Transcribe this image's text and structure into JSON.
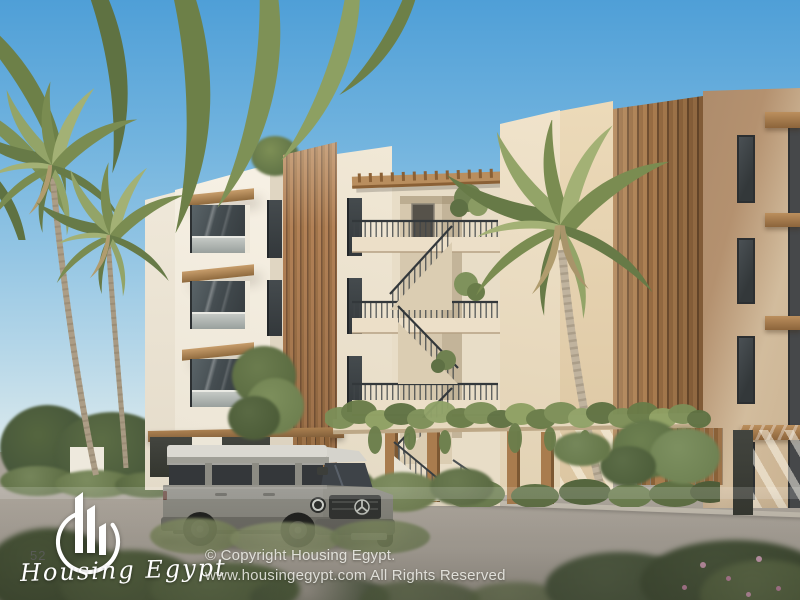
{
  "watermark": {
    "brand": "Housing Egypt",
    "unit_number": "52",
    "copyright_line1": "© Copyright Housing Egypt.",
    "copyright_line2": "www.housingegypt.com All Rights Reserved"
  },
  "palette": {
    "sky_top": "#4f9fd7",
    "sky_horizon": "#d9e8ec",
    "wall_white": "#f4eee2",
    "wall_cream": "#ecdfc8",
    "wall_tan": "#c3a483",
    "wood_slats": "#a87c4e",
    "window_glass": "#3c4145",
    "railing_metal": "#474b4e",
    "foliage_green": "#75875a",
    "road_asphalt": "#aba49a",
    "car_body_gray": "#8a8981",
    "watermark_white": "#ffffff"
  }
}
